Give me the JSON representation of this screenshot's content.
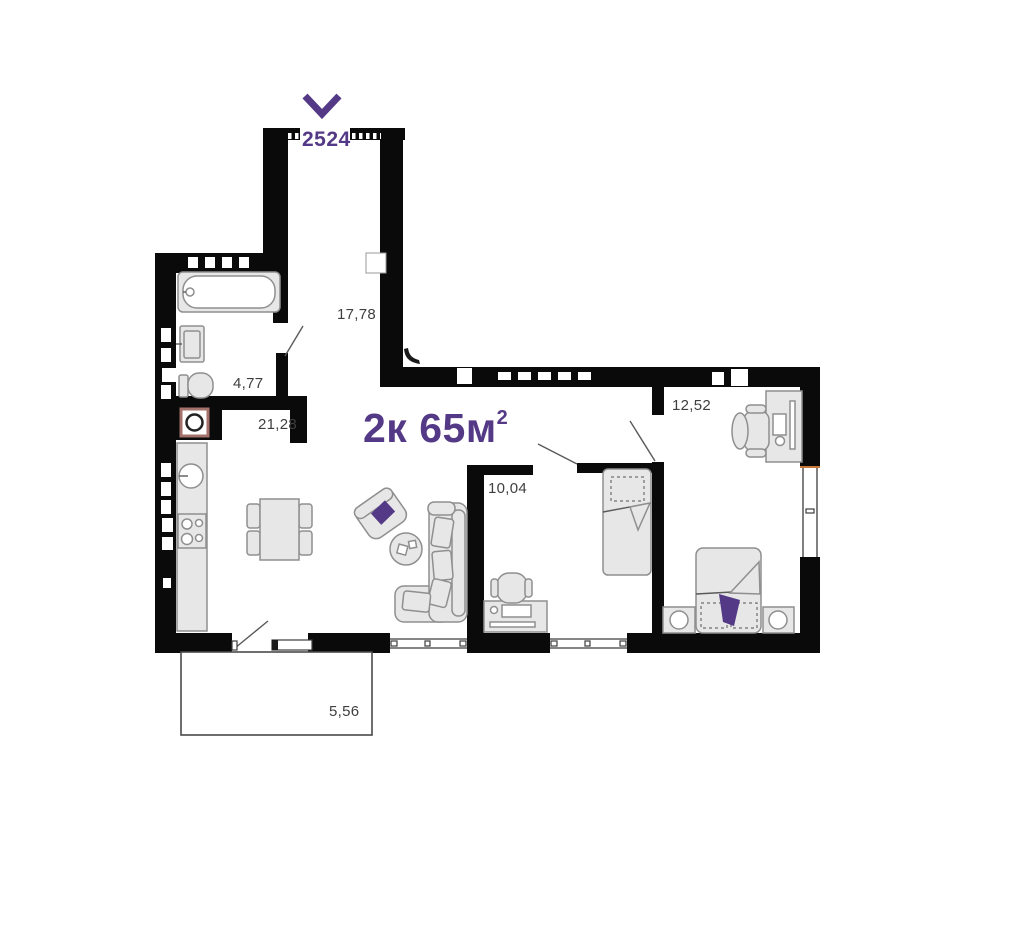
{
  "plan": {
    "title": {
      "main": "2к 65м",
      "sup": "2"
    },
    "entrance": {
      "width_label": "2524"
    },
    "rooms": {
      "hallway": {
        "name": "hallway",
        "area": "17,78"
      },
      "bathroom": {
        "name": "bathroom",
        "area": "4,77"
      },
      "kitchen_living": {
        "name": "kitchen-living",
        "area": "21,28"
      },
      "bedroom": {
        "name": "bedroom",
        "area": "12,52"
      },
      "room": {
        "name": "room",
        "area": "10,04"
      },
      "balcony": {
        "name": "balcony",
        "area": "5,56"
      }
    },
    "colors": {
      "accent": "#543a86",
      "wall": "#0a0a0a",
      "furniture_fill": "#e7e7e7",
      "furniture_stroke": "#8f8f8f",
      "label": "#3f3f3f",
      "washer_accent": "#a5716b",
      "background": "#ffffff"
    }
  }
}
